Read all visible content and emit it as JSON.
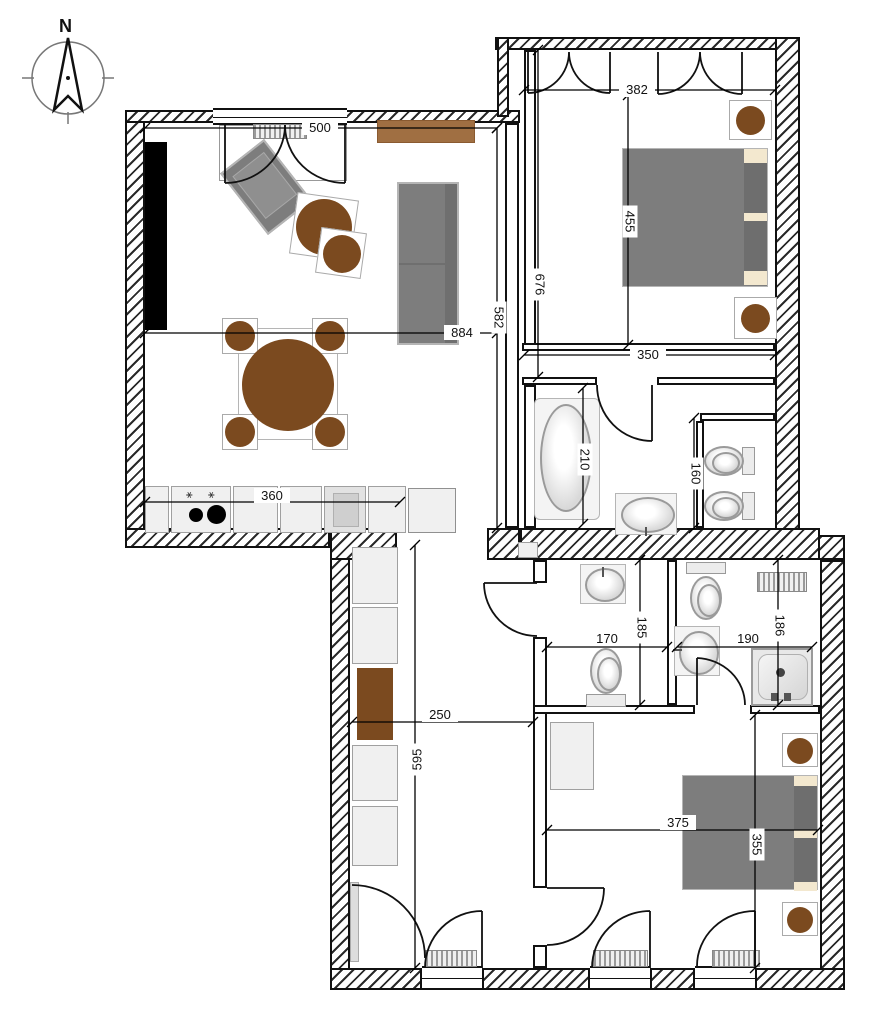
{
  "compass": {
    "north_label": "N"
  },
  "dimensions": {
    "living_window": "500",
    "living_width": "884",
    "living_height": "582",
    "bedroom1_top_width": "382",
    "bedroom1_bed_span": "455",
    "bedroom1_height": "676",
    "bedroom1_bottom_width": "350",
    "bathroom_height": "210",
    "wc_height": "160",
    "kitchen_counter": "360",
    "bath_small_width": "170",
    "bath_small_height": "185",
    "shower_room_width": "190",
    "shower_room_height": "186",
    "hall_width": "250",
    "hall_height": "595",
    "bedroom2_width": "375",
    "bedroom2_bed_span": "355"
  },
  "colors": {
    "wall_line": "#111111",
    "furniture_gray": "#7d7d7d",
    "wood_brown": "#7b4a1f",
    "sideboard_brown": "#a06f42",
    "pillow_beige": "#f3e8cf"
  }
}
